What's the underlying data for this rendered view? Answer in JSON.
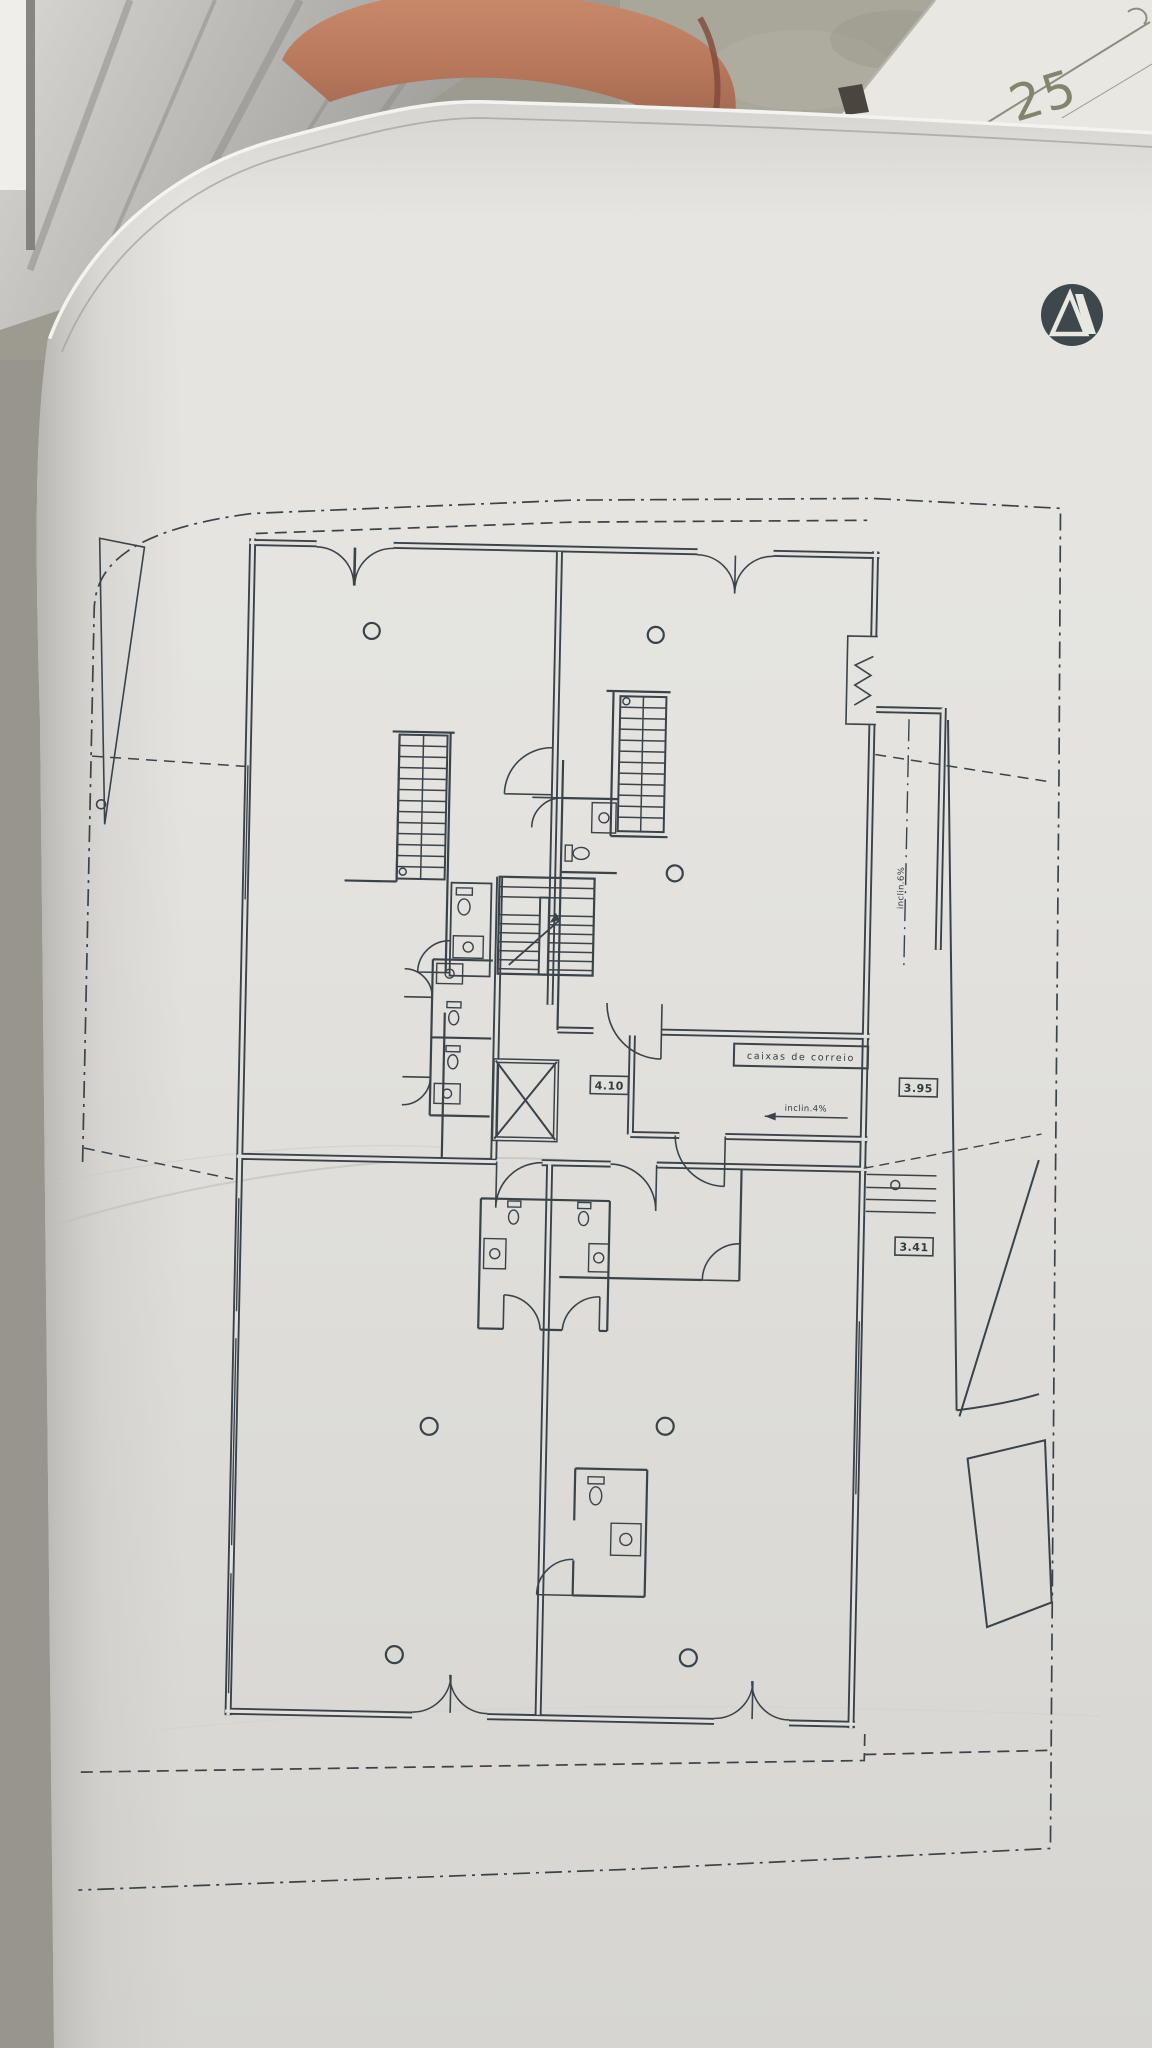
{
  "photo": {
    "handwritten_number": "25",
    "colors": {
      "paper": "#e2e1dd",
      "ink": "#3b434a",
      "terracotta_object": "#bd7f62",
      "table_surface": "#a9a79a",
      "window_frame": "#c3c2be",
      "second_sheet": "#e8e7e2",
      "logo": "#3d474c"
    }
  },
  "plan": {
    "title_hint": "floor-plan-sheet",
    "labels": {
      "mailbox_unit": "caixas de correio",
      "hall_width": "4.10",
      "corridor_width": "3.95",
      "patio_width": "3.41",
      "corridor_slope": "inclin.4%",
      "ramp_slope": "inclin.6%"
    }
  }
}
